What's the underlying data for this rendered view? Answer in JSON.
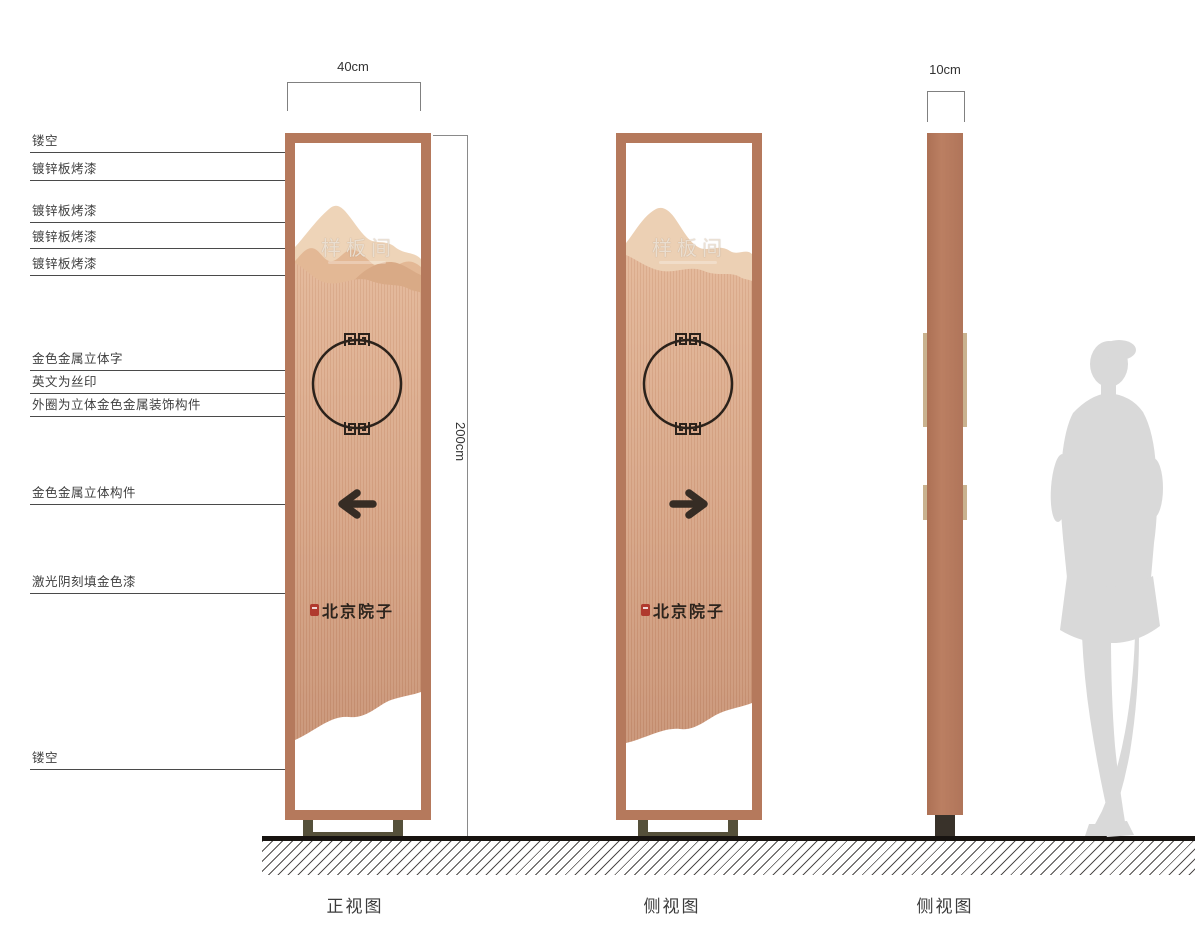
{
  "callouts": [
    {
      "label": "镂空"
    },
    {
      "label": "镀锌板烤漆"
    },
    {
      "label": "镀锌板烤漆"
    },
    {
      "label": "镀锌板烤漆"
    },
    {
      "label": "镀锌板烤漆"
    },
    {
      "label": "金色金属立体字"
    },
    {
      "label": "英文为丝印"
    },
    {
      "label": "外圈为立体金色金属装饰构件"
    },
    {
      "label": "金色金属立体构件"
    },
    {
      "label": "激光阴刻填金色漆"
    },
    {
      "label": "镂空"
    }
  ],
  "dimensions": {
    "front_width": "40cm",
    "total_height": "200cm",
    "side_depth": "10cm"
  },
  "signage": {
    "room_name": "样板间",
    "brand_name": "北京院子"
  },
  "views": [
    {
      "caption": "正视图"
    },
    {
      "caption": "侧视图"
    },
    {
      "caption": "侧视图"
    }
  ],
  "colors": {
    "copper_frame": "#b5795c",
    "mountain_light": "#eed4b8",
    "mountain_mid": "#e3b895",
    "mountain_dark": "#d9aa86",
    "panel_body_top": "#e2b494",
    "panel_body_bottom": "#c79071",
    "circle_outline": "#2b221b",
    "arrow": "#362c24",
    "brand_text": "#2c241d",
    "seal_red": "#b03a2e",
    "base_olive": "#55503a",
    "base_dark": "#39322a",
    "ground": "#171310",
    "silhouette": "#d9d9d9",
    "label_text": "#3f3f3f"
  }
}
